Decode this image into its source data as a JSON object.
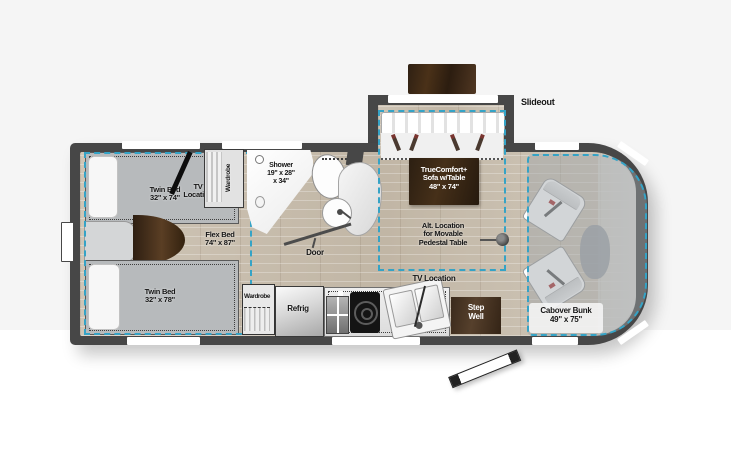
{
  "page": {
    "background": "#ffffff",
    "band_color": "#f5f5f5"
  },
  "floorplan": {
    "slideout_label": "Slideout",
    "labels": {
      "twin_bed_top": {
        "name": "Twin Bed",
        "size": "32\" x 74\""
      },
      "tv_location_bedroom": {
        "line1": "TV",
        "line2": "Location"
      },
      "wardrobe_top": "Wardrobe",
      "shower": {
        "name": "Shower",
        "size1": "19\" x 28\"",
        "size2": "x 34\""
      },
      "flex_bed": {
        "name": "Flex Bed",
        "size": "74\" x 87\""
      },
      "twin_bed_bottom": {
        "name": "Twin Bed",
        "size": "32\" x 78\""
      },
      "wardrobe_bottom": "Wardrobe",
      "refrig": "Refrig",
      "door": "Door",
      "sofa": {
        "line1": "TrueComfort+",
        "line2": "Sofa w/Table",
        "line3": "48\" x 74\""
      },
      "alt_table": {
        "line1": "Alt. Location",
        "line2": "for Movable",
        "line3": "Pedestal Table"
      },
      "tv_location_kitchen": "TV Location",
      "step_well": {
        "line1": "Step",
        "line2": "Well"
      },
      "cabover_bunk": {
        "name": "Cabover Bunk",
        "size": "49\" x 75\""
      }
    },
    "colors": {
      "wall": "#474747",
      "floor_wood": "#c8beaf",
      "bed_gray": "#b7babc",
      "dash_blue": "#35a3c6",
      "label_wood_brown": "#3b2a18",
      "step_well_brown": "#473322",
      "stored_table_brown": "#39281a"
    }
  }
}
